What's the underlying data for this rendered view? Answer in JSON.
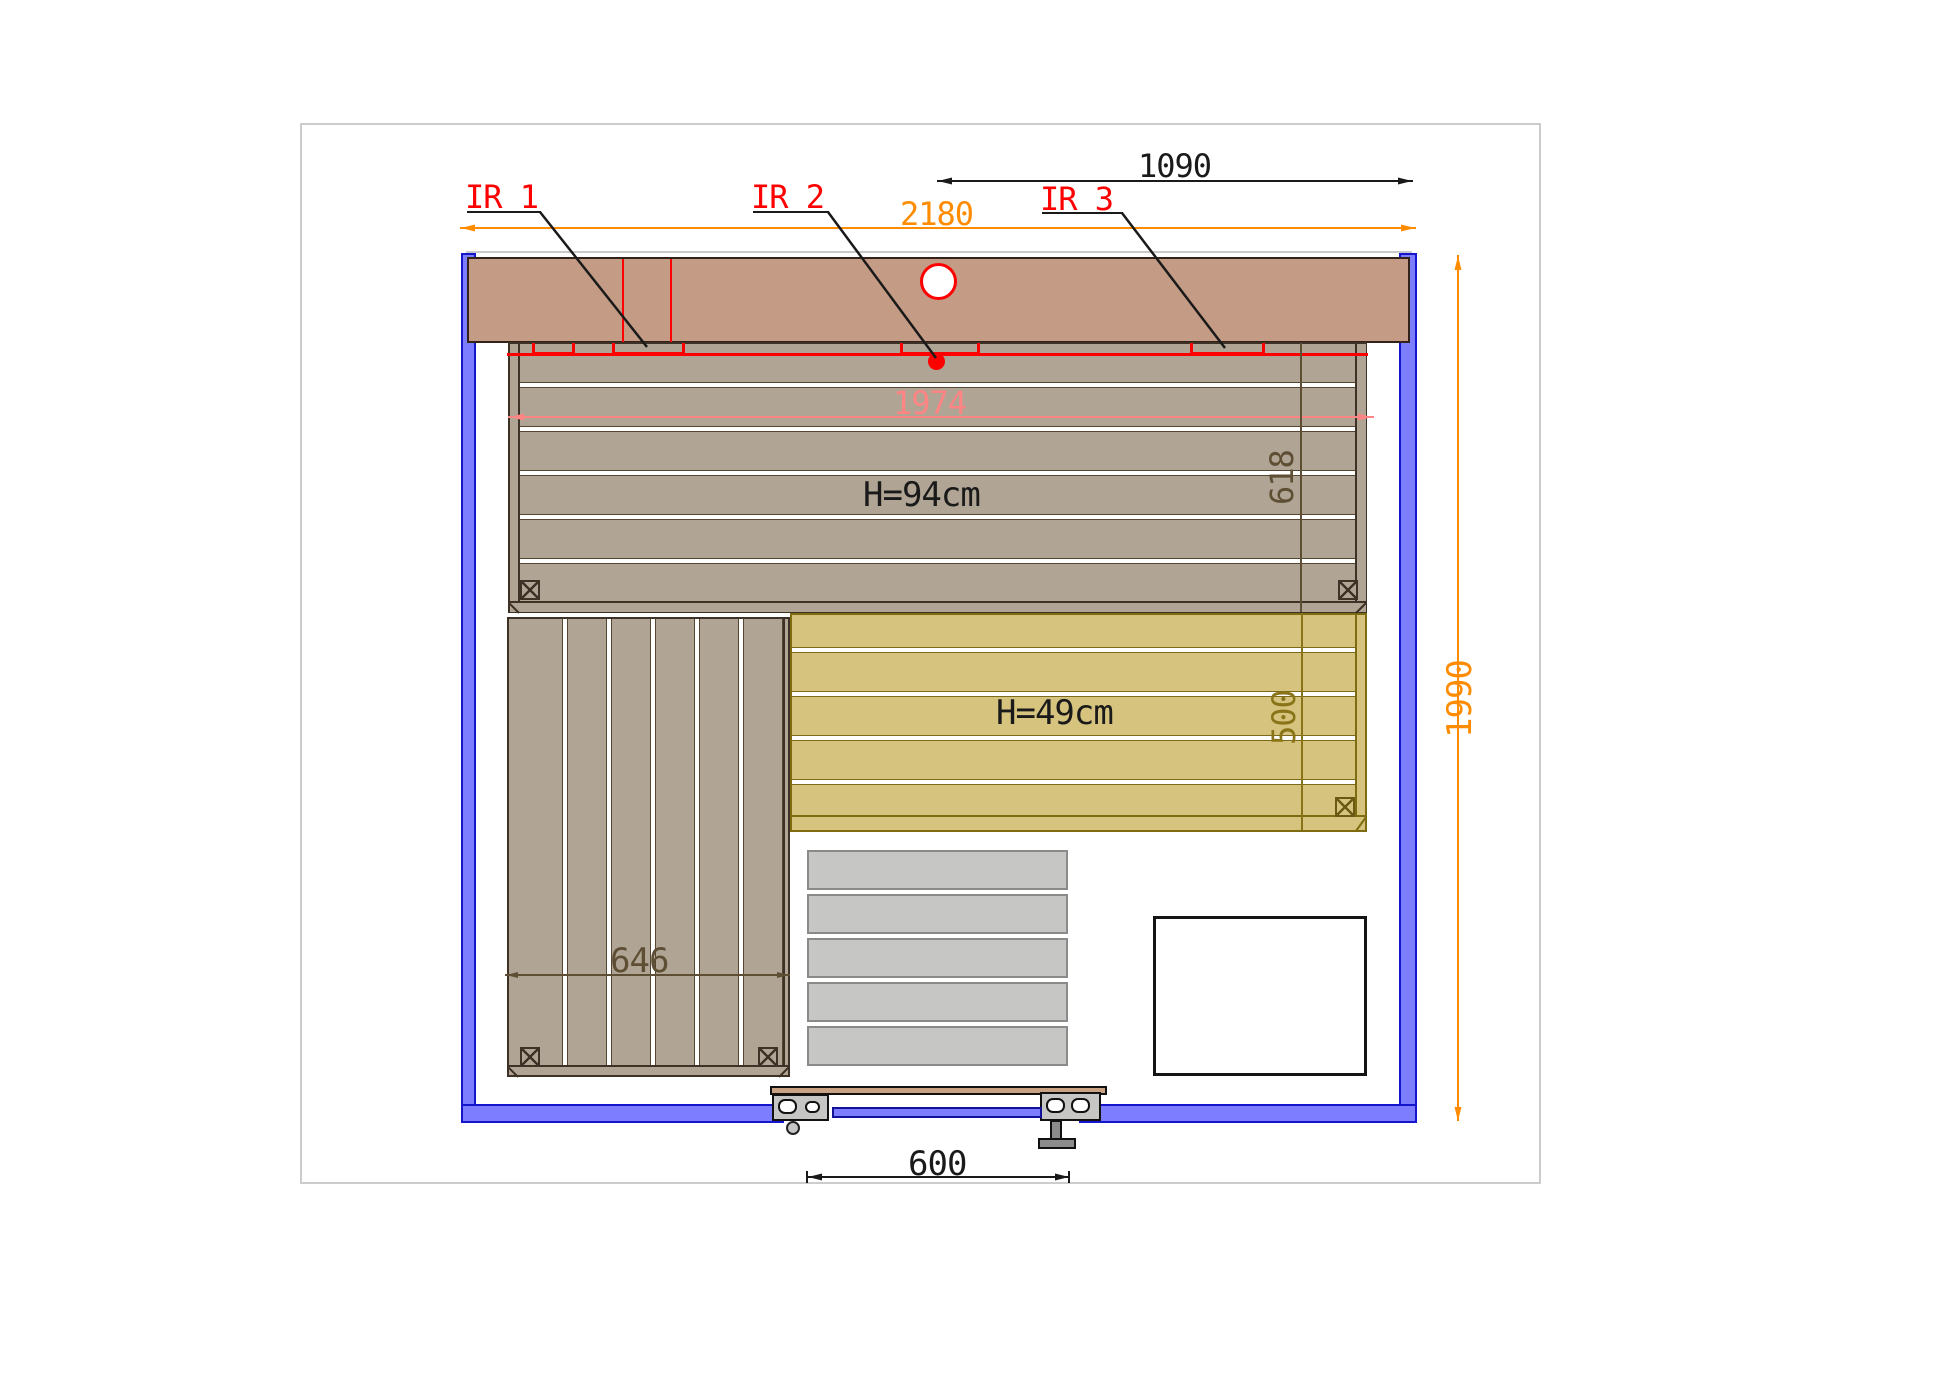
{
  "drawing": {
    "ir_labels": [
      {
        "label": "IR 1"
      },
      {
        "label": "IR 2"
      },
      {
        "label": "IR 3"
      }
    ],
    "bench_labels": {
      "upper": "H=94cm",
      "lower": "H=49cm"
    },
    "dimensions": {
      "width_half": "1090",
      "width_total": "2180",
      "bench_length": "1974",
      "bench_depth": "618",
      "lower_bench_depth": "500",
      "room_depth": "1990",
      "side_bench_width": "646",
      "door_width": "600"
    },
    "colors": {
      "wall_fill": "#7D7DFF",
      "wall_edge": "#1515CE",
      "top_bench_fill": "#C49B84",
      "bench_fill": "#B0A494",
      "bench_edge": "#3E3226",
      "lower_bench_fill": "#D5C37E",
      "lower_bench_edge": "#806C10",
      "slat_fill": "#C6C6C4",
      "heater_edge": "#151515",
      "red": "#FF0000",
      "pink": "#FF8585",
      "orange": "#FF8C00",
      "dim_brown": "#5E4E33",
      "dim_olive": "#8A7418",
      "black": "#1A1A1A"
    }
  }
}
